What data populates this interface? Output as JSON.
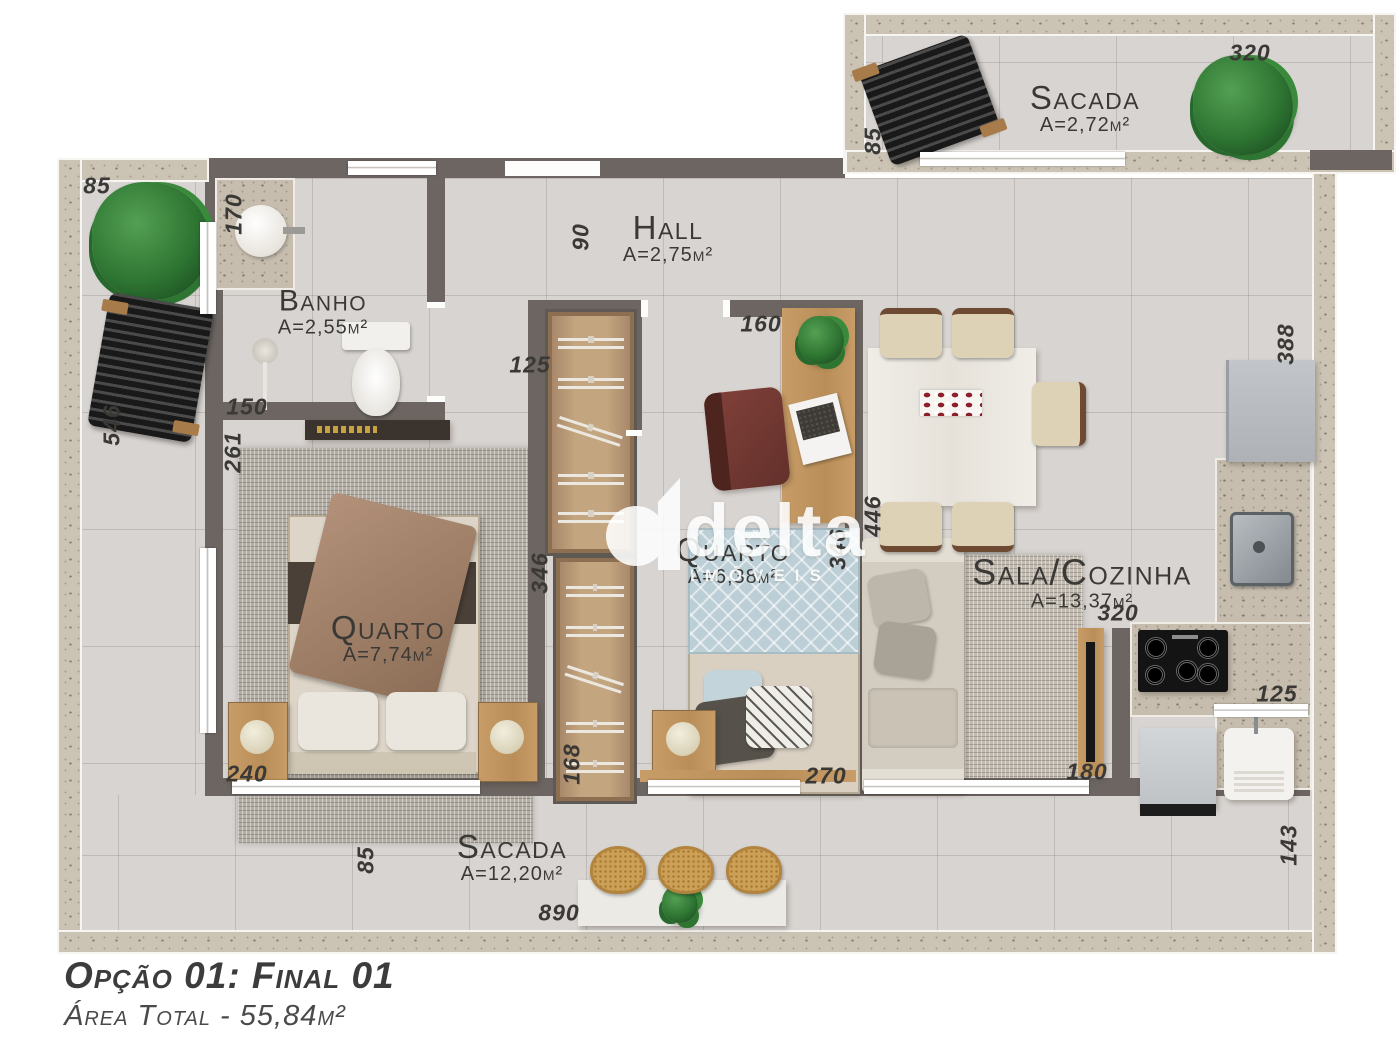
{
  "footer": {
    "title": "Opção 01: Final 01",
    "subtitle": "Área Total - 55,84m²"
  },
  "watermark": {
    "brand": "delta",
    "sub": "IMÓVEIS"
  },
  "rooms": {
    "sacada_top": {
      "name": "Sacada",
      "area": "A=2,72m²"
    },
    "hall": {
      "name": "Hall",
      "area": "A=2,75m²"
    },
    "banho": {
      "name": "Banho",
      "area": "A=2,55m²"
    },
    "quarto1": {
      "name": "Quarto",
      "area": "A=7,74m²"
    },
    "quarto2": {
      "name": "Quarto",
      "area": "A=6,38m²"
    },
    "sala": {
      "name": "Sala/Cozinha",
      "area": "A=13,37m²"
    },
    "sacada_bottom": {
      "name": "Sacada",
      "area": "A=12,20m²"
    }
  },
  "dims": {
    "sacada_top_320": "320",
    "sacada_top_85": "85",
    "balcony_85": "85",
    "balcony_546": "546",
    "banho_170": "170",
    "banho_150": "150",
    "hall_90": "90",
    "closet_125": "125",
    "closet_168": "168",
    "quarto1_261": "261",
    "quarto1_346": "346",
    "quarto1_240": "240",
    "quarto2_160": "160",
    "quarto2_346": "346",
    "quarto2_270": "270",
    "sala_446": "446",
    "sala_388": "388",
    "kitchen_320": "320",
    "kitchen_125": "125",
    "kitchen_180": "180",
    "kitchen_143": "143",
    "sacada_bottom_85": "85",
    "sacada_bottom_890": "890"
  },
  "colors": {
    "interior_wall": "#6c6561",
    "exterior_wall": "#cbc3b4",
    "floor": "#d8d4d1",
    "text": "#3b3936",
    "wood": "#c89c66",
    "plant_green": "#2e7532"
  }
}
